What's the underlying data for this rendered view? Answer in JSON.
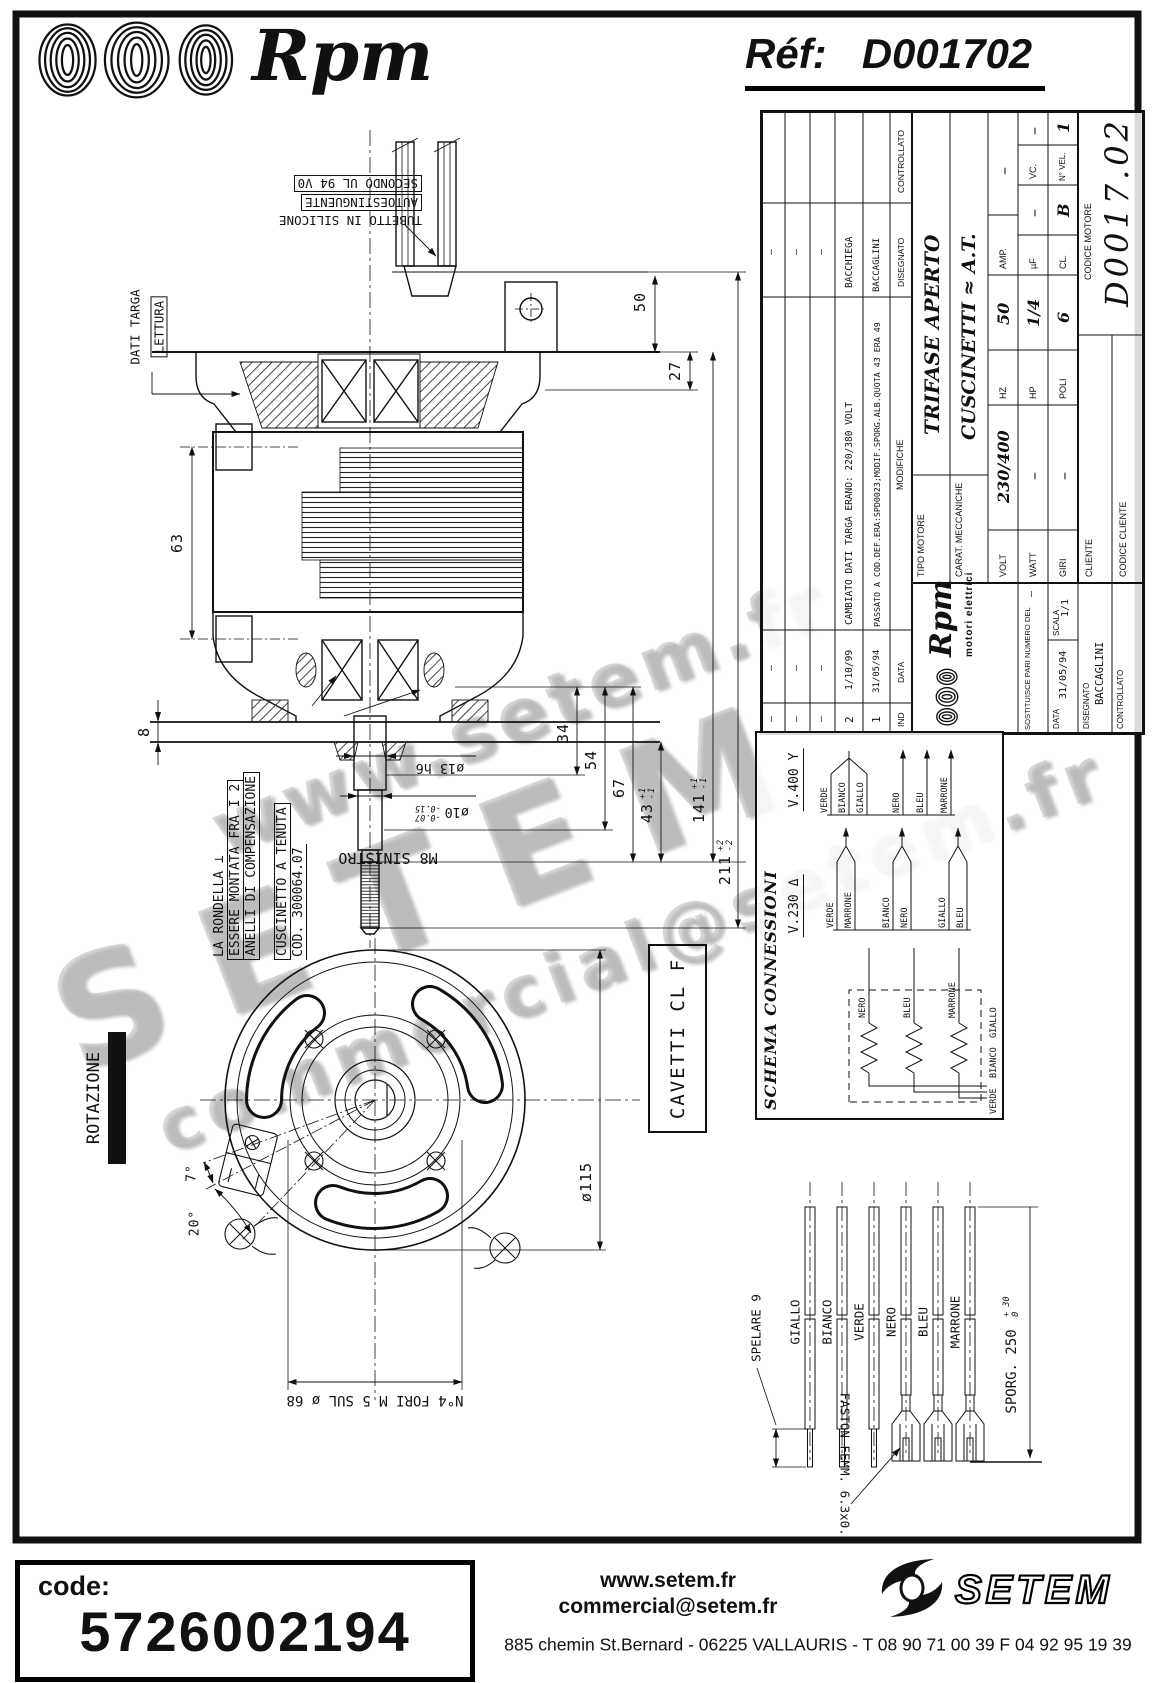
{
  "header": {
    "brand": "Rpm",
    "ref_label": "Réf:",
    "ref_value": "D001702"
  },
  "watermarks": {
    "wm1": "www.setem.fr",
    "wm2": "SETEM",
    "wm3": "commercial@setem.fr"
  },
  "callouts": {
    "tubetto1": "TUBETTO IN SILICONE",
    "tubetto2": "AUTOESTINGUENTE",
    "tubetto3": "SECONDO UL 94 V0",
    "dati_targa": "DATI TARGA",
    "lettura": "LETTURA",
    "rondella1": "LA RONDELLA ⊥",
    "rondella2": "ESSERE MONTATA FRA I 2",
    "rondella3": "ANELLI DI COMPENSAZIONE",
    "cuscinetto1": "CUSCINETTO A TENUTA",
    "cuscinetto2": "COD. 300064.07",
    "m8": "M8 SINISTRO",
    "rotazione": "ROTAZIONE",
    "cavetti": "CAVETTI CL F",
    "fori": "N°4 FORI M 5 SUL ø 68",
    "spelare": "SPELARE 9",
    "sporg": "SPORG. 250",
    "sporg_tol_up": "+ 30",
    "sporg_tol_dn": "0",
    "faston": "FASTON FEMM. 6.3x0.8"
  },
  "dims": {
    "d50": "50",
    "d27": "27",
    "d63": "63",
    "d8": "8",
    "d34": "34",
    "d54": "54",
    "d67": "67",
    "d43": "43",
    "d43_tol_up": "+1",
    "d43_tol_dn": "-1",
    "d141": "141",
    "d141_tol_up": "+1",
    "d141_tol_dn": "-1",
    "d211": "211",
    "d211_tol_up": "+2",
    "d211_tol_dn": "-2",
    "dia115": "ø115",
    "dia13": "ø13 h6",
    "dia10": "ø10",
    "dia10_tol_up": "-0.07",
    "dia10_tol_dn": "-0.15",
    "deg7": "7°",
    "deg20": "20°"
  },
  "title_block": {
    "rev_rows": [
      {
        "ind": "–",
        "date": "–",
        "desc": "",
        "name": "–"
      },
      {
        "ind": "–",
        "date": "–",
        "desc": "",
        "name": "–"
      },
      {
        "ind": "–",
        "date": "–",
        "desc": "",
        "name": "–"
      },
      {
        "ind": "2",
        "date": "1/10/99",
        "desc": "CAMBIATO DATI TARGA ERANO: 220/380 VOLT",
        "name": "BACCHIEGA"
      },
      {
        "ind": "1",
        "date": "31/05/94",
        "desc": "PASSATO A COD.DEF.ERA:SPD0023;MODIF.SPORG.ALB.QUOTA 43 ERA 49",
        "name": "BACCAGLINI"
      }
    ],
    "header": {
      "ind": "IND",
      "date": "DATA",
      "desc": "MODIFICHE",
      "drawn": "DISEGNATO",
      "checked": "CONTROLLATO"
    },
    "logo_brand": "Rpm",
    "logo_sub": "motori elettrici",
    "sostituisce_label": "SOSTITUISCE PARI NUMERO DEL",
    "sostituisce_value": "–",
    "data_label": "DATA",
    "data_value": "31/05/94",
    "scala_label": "SCALA",
    "scala_value": "1/1",
    "disegnato_label": "DISEGNATO",
    "disegnato_value": "BACCAGLINI",
    "controllato_label": "CONTROLLATO",
    "controllato_value": "",
    "tipo_label": "TIPO MOTORE",
    "tipo_value": "TRIFASE APERTO",
    "carat_label": "CARAT. MECCANICHE",
    "carat_value": "CUSCINETTI ≈ A.T.",
    "volt_label": "VOLT",
    "volt_value": "230/400",
    "hz_label": "HZ",
    "hz_value": "50",
    "amp_label": "AMP.",
    "amp_value": "–",
    "watt_label": "WATT",
    "watt_value": "–",
    "hp_label": "HP",
    "hp_value": "1/4",
    "uf_label": "µF",
    "uf_value": "–",
    "vc_label": "VC.",
    "vc_value": "–",
    "giri_label": "GIRI",
    "giri_value": "–",
    "poli_label": "POLI",
    "poli_value": "6",
    "cl_label": "CL.",
    "cl_value": "B",
    "nvel_label": "N° VEL.",
    "nvel_value": "1",
    "cliente_label": "CLIENTE",
    "codice_cliente_label": "CODICE CLIENTE",
    "codice_motore_label": "CODICE MOTORE",
    "codice_motore_value": "D0017.02"
  },
  "schema": {
    "title": "SCHEMA CONNESSIONI",
    "v400": {
      "label": "V.400",
      "symbol": "Y"
    },
    "v230": {
      "label": "V.230",
      "symbol": "Δ"
    },
    "star_wires": [
      "VERDE",
      "BIANCO",
      "GIALLO"
    ],
    "line_wires": [
      "NERO",
      "BLEU",
      "MARRONE"
    ],
    "delta_pairs": [
      [
        "VERDE",
        "MARRONE"
      ],
      [
        "BIANCO",
        "NERO"
      ],
      [
        "GIALLO",
        "BLEU"
      ]
    ],
    "winding_top": [
      "NERO",
      "BLEU",
      "MARRONE"
    ],
    "winding_bottom": [
      "VERDE",
      "BIANCO",
      "GIALLO"
    ]
  },
  "wires": {
    "labels": [
      "GIALLO",
      "BIANCO",
      "VERDE",
      "NERO",
      "BLEU",
      "MARRONE"
    ]
  },
  "footer": {
    "code_label": "code:",
    "code_value": "5726002194",
    "web": "www.setem.fr",
    "email": "commercial@setem.fr",
    "address": "885 chemin St.Bernard  -  06225 VALLAURIS  -  T 08 90 71 00 39   F 04 92 95 19 39",
    "brand": "SETEM"
  }
}
